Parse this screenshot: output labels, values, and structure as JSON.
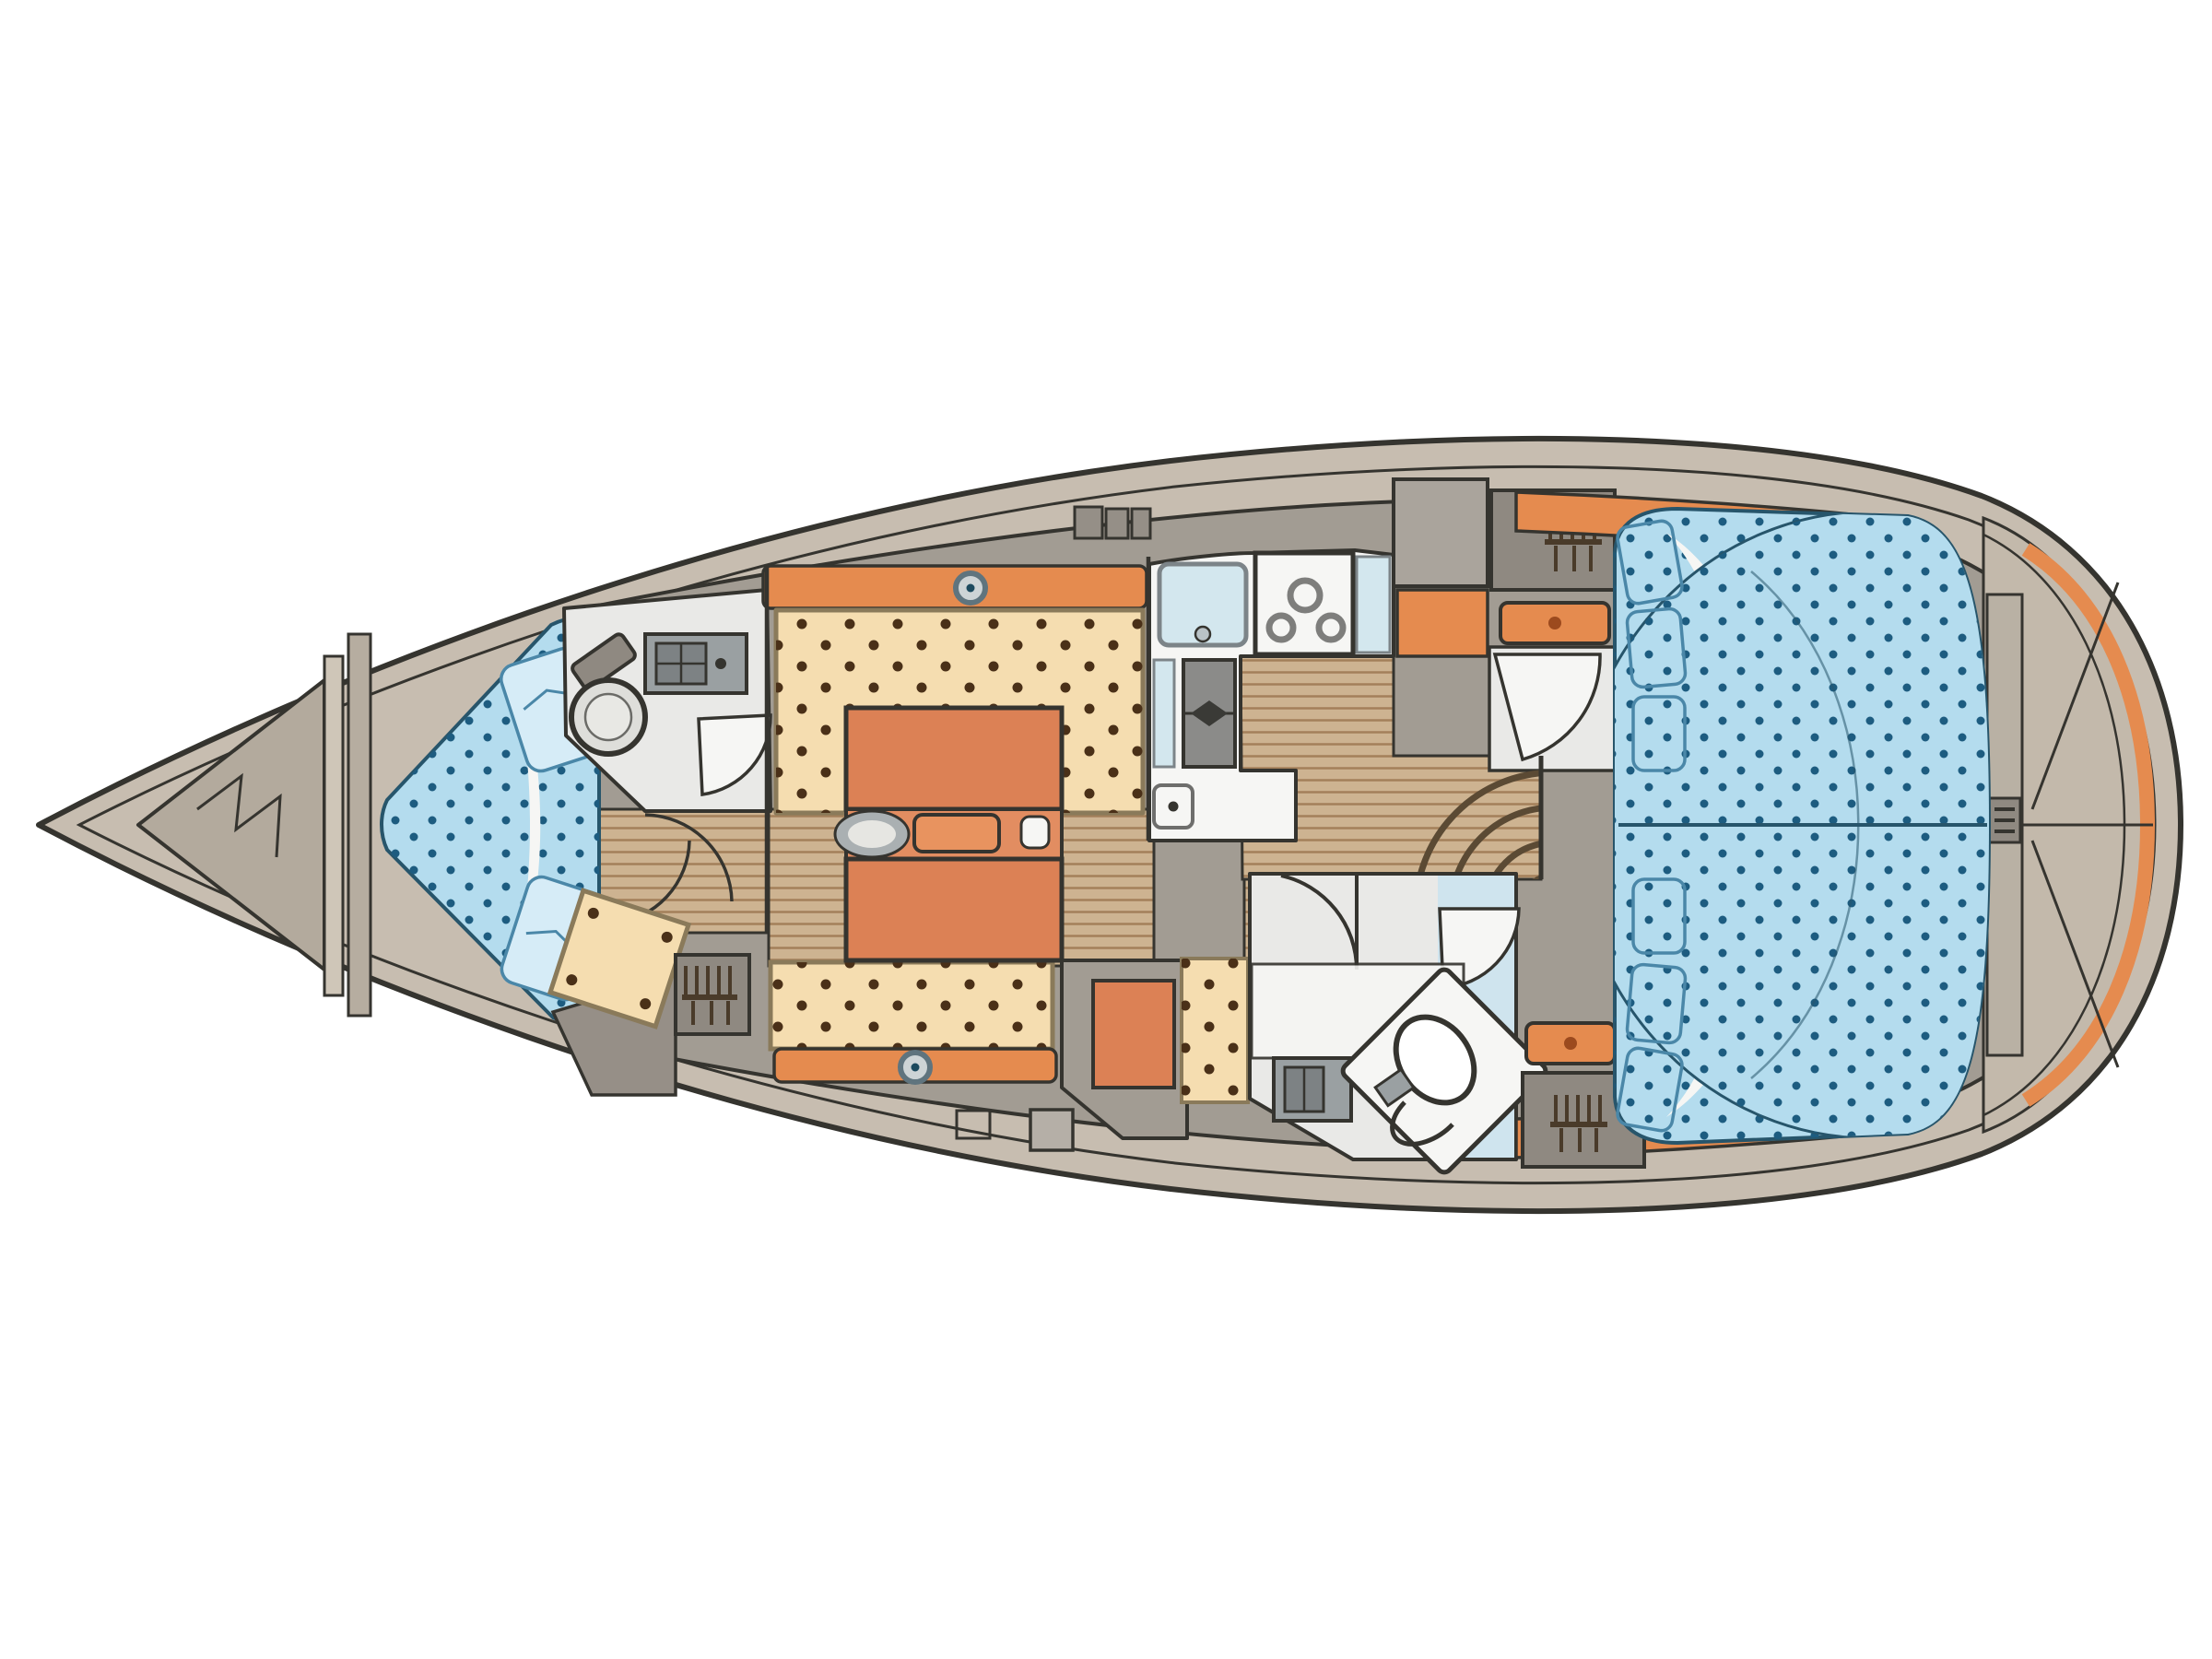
{
  "figure": {
    "type": "boat-floor-plan",
    "title": "Sailing yacht interior layout plan, top view, bow pointing left",
    "orientation": "bow-left",
    "text_on_image": "none"
  },
  "colors": {
    "ink": "#35342f",
    "hull_rim": "#c7bdb0",
    "deck_grey": "#a29c93",
    "transom_tan": "#c3b9ab",
    "wood": "#cdb391",
    "wood_line": "#a3805a",
    "cushion": "#f5ddb0",
    "cushion_edge": "#8a7a5a",
    "cushion_dot": "#4a3018",
    "orange": "#e58b4f",
    "table_orange": "#dc8155",
    "table_mid": "#e28d61",
    "berth_blue": "#b4dcee",
    "berth_line": "#27556b",
    "berth_dot": "#1d5c80",
    "pillow_blue": "#d6ecf7",
    "pillow_line": "#4a87a8",
    "white": "#f6f6f4",
    "head_floor": "#e9e9e7",
    "blue_floor": "#cfe4ee",
    "sink_blue": "#d3e7ee",
    "appliance": "#8b8b89",
    "cabinet_light": "#aaa49c",
    "cabinet_dark": "#8f8981",
    "steel": "#9aa0a2",
    "comb": "#4a3b2a",
    "step_line": "#5b4a34"
  },
  "regions": [
    {
      "name": "anchor-locker",
      "position": "bow"
    },
    {
      "name": "forward-cabin-v-berth",
      "position": "forward"
    },
    {
      "name": "forward-head-toilet",
      "position": "forward-port-top"
    },
    {
      "name": "forward-seat-and-wardrobe",
      "position": "forward-starboard-bottom"
    },
    {
      "name": "saloon-u-settee-and-folding-table",
      "position": "midship"
    },
    {
      "name": "galley-l-shaped",
      "position": "midship-top"
    },
    {
      "name": "companionway-steps",
      "position": "midship-aft"
    },
    {
      "name": "nav-seat",
      "position": "aft-bottom-left"
    },
    {
      "name": "aft-head-toilet",
      "position": "aft-bottom"
    },
    {
      "name": "aft-cabin-double-berth",
      "position": "aft"
    },
    {
      "name": "transom-stern-platform",
      "position": "stern"
    }
  ]
}
